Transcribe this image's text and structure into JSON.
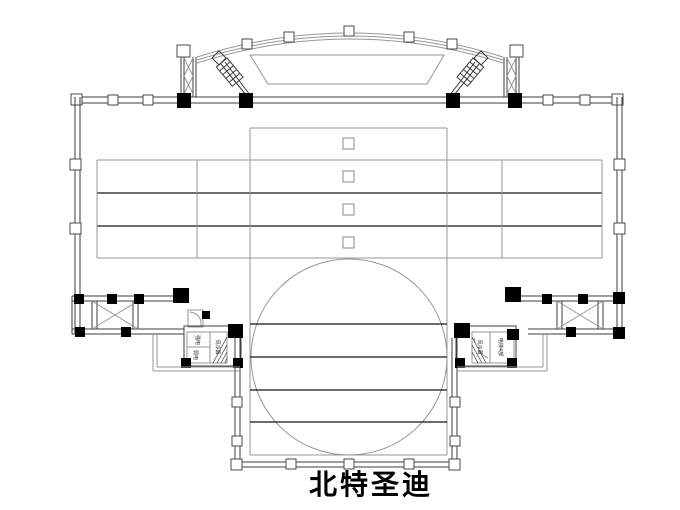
{
  "title": {
    "text": "北特圣迪"
  },
  "colors": {
    "background": "#ffffff",
    "wall_line": "#3d3d3d",
    "light_line": "#969696",
    "dark_line": "#141414",
    "column_fill": "#000000"
  },
  "labels": {
    "left_core_top": "强电",
    "left_core_bottom": "弱电",
    "left_core_side": "风冷幕",
    "right_core_side": "风冷幕",
    "right_core_main": "电梯4部"
  }
}
